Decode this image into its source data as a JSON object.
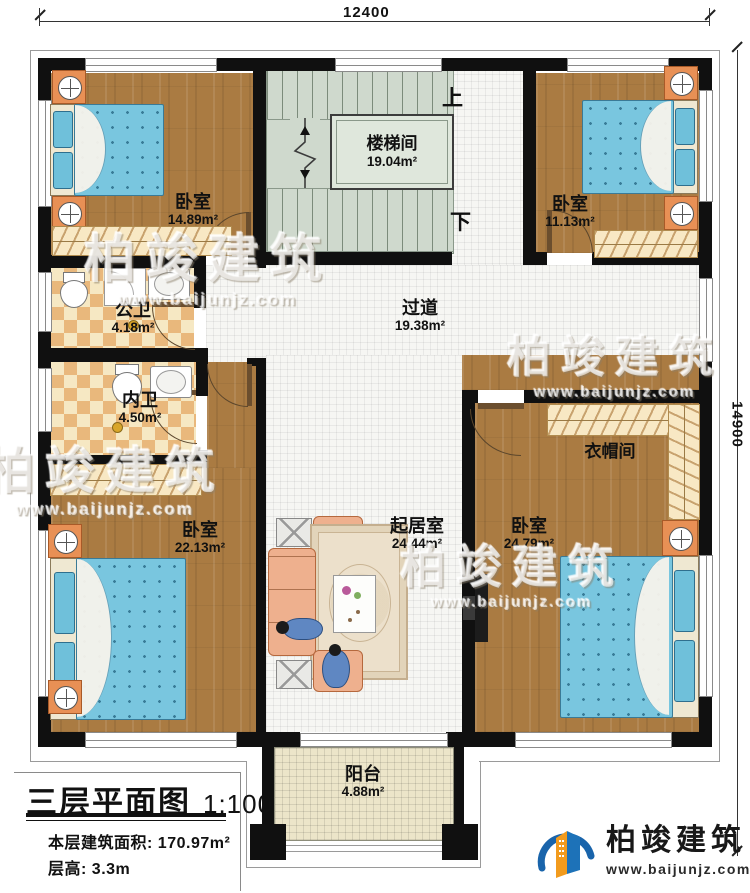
{
  "dimensions": {
    "top": "12400",
    "right": "14900"
  },
  "stairs": {
    "up": "上",
    "down": "下"
  },
  "rooms": {
    "bedroom_top_left": {
      "name": "卧室",
      "area": "14.89m²"
    },
    "stairwell": {
      "name": "楼梯间",
      "area": "19.04m²"
    },
    "bedroom_top_right": {
      "name": "卧室",
      "area": "11.13m²"
    },
    "public_bathroom": {
      "name": "公卫",
      "area": "4.18m²"
    },
    "private_bathroom": {
      "name": "内卫",
      "area": "4.50m²"
    },
    "hallway": {
      "name": "过道",
      "area": "19.38m²"
    },
    "cloakroom": {
      "name": "衣帽间"
    },
    "bedroom_bottom_left": {
      "name": "卧室",
      "area": "22.13m²"
    },
    "bedroom_bottom_right": {
      "name": "卧室",
      "area": "24.79m²"
    },
    "living_room": {
      "name": "起居室",
      "area": "24.44m²"
    },
    "balcony": {
      "name": "阳台",
      "area": "4.88m²"
    }
  },
  "title_block": {
    "title": "三层平面图",
    "scale": "1:100",
    "area_label": "本层建筑面积:",
    "area_value": "170.97m²",
    "height_label": "层高:",
    "height_value": "3.3m"
  },
  "branding": {
    "company": "柏竣建筑",
    "website": "www.baijunjz.com"
  },
  "watermark": {
    "text": "柏竣建筑",
    "url": "www.baijunjz.com"
  }
}
